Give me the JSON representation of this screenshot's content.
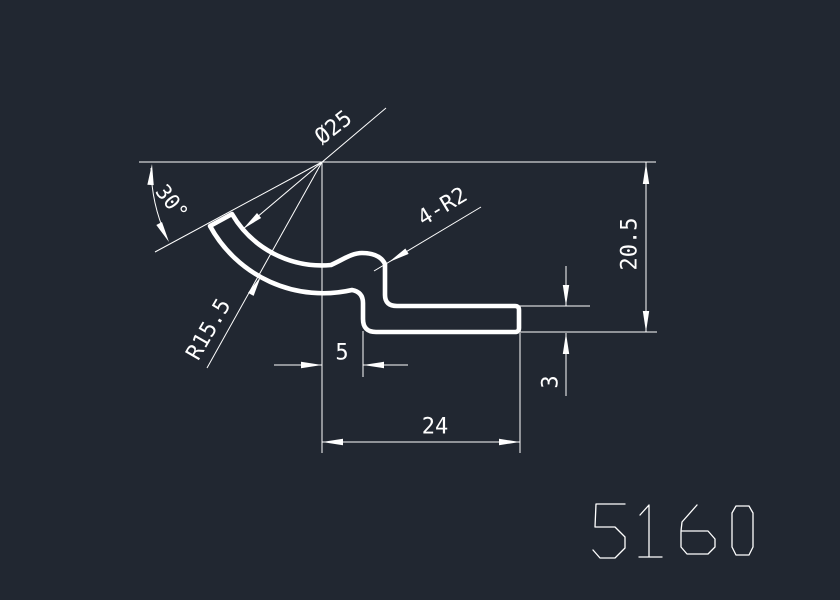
{
  "colors": {
    "background": "#212731",
    "line": "#ffffff"
  },
  "drawing": {
    "part_number": "5160",
    "labels": {
      "diameter": "Ø25",
      "angle": "30°",
      "radius": "R15.5",
      "fillet_note": "4-R2",
      "step_width": "5",
      "base_length": "24",
      "thickness": "3",
      "overall_height": "20.5"
    }
  }
}
